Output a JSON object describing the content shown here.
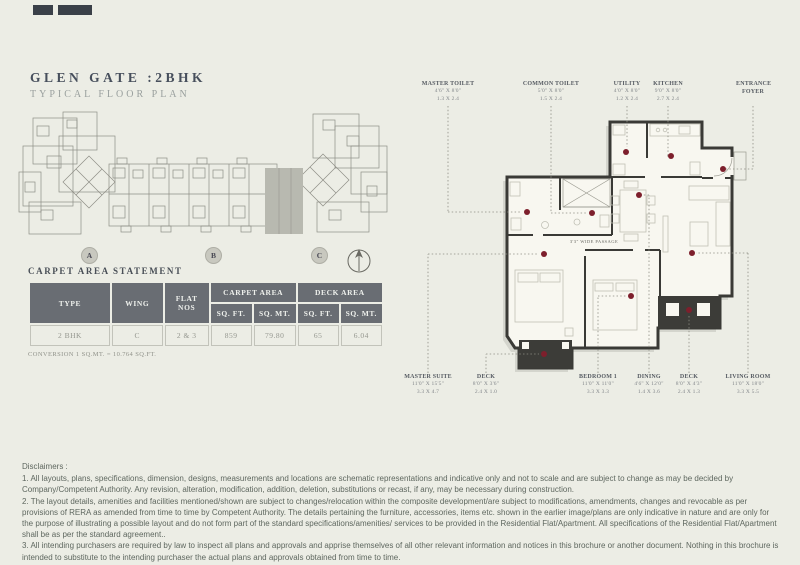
{
  "header": {
    "title": "GLEN GATE :2BHK",
    "subtitle": "TYPICAL FLOOR PLAN"
  },
  "key_plan": {
    "markers": [
      "A",
      "B",
      "C"
    ],
    "compass": "north-arrow",
    "highlight_color": "#b8b9b0"
  },
  "carpet_area": {
    "heading": "CARPET AREA STATEMENT",
    "columns": {
      "type": "TYPE",
      "wing": "WING",
      "flat_nos": "FLAT NOS",
      "carpet_area": "CARPET AREA",
      "deck_area": "DECK AREA",
      "sqft": "SQ. FT.",
      "sqmt": "SQ. MT."
    },
    "row": [
      "2 BHK",
      "C",
      "2 & 3",
      "859",
      "79.80",
      "65",
      "6.04"
    ],
    "note": "CONVERSION 1 SQ.MT. = 10.764 SQ.FT."
  },
  "floor_plan": {
    "passage_label": "3'3\" WIDE PASSAGE",
    "accent_dot_color": "#7d1f2c",
    "labels_top": [
      {
        "name": "MASTER TOILET",
        "ft": "4'6\" X 8'0\"",
        "mt": "1.3 X 2.4"
      },
      {
        "name": "COMMON TOILET",
        "ft": "5'0\" X 8'0\"",
        "mt": "1.5 X 2.4"
      },
      {
        "name": "UTILITY",
        "ft": "4'0\" X 8'0\"",
        "mt": "1.2 X 2.4"
      },
      {
        "name": "KITCHEN",
        "ft": "9'0\" X 8'0\"",
        "mt": "2.7 X 2.4"
      },
      {
        "name": "ENTRANCE FOYER",
        "ft": "",
        "mt": ""
      }
    ],
    "labels_bottom": [
      {
        "name": "MASTER SUITE",
        "ft": "11'0\" X 15'5\"",
        "mt": "3.3 X 4.7"
      },
      {
        "name": "DECK",
        "ft": "8'0\" X 3'6\"",
        "mt": "2.4 X 1.0"
      },
      {
        "name": "BEDROOM 1",
        "ft": "11'0\" X 11'0\"",
        "mt": "3.3 X 3.3"
      },
      {
        "name": "DINING",
        "ft": "4'6\" X 12'0\"",
        "mt": "1.4 X 3.6"
      },
      {
        "name": "DECK",
        "ft": "8'0\" X 4'3\"",
        "mt": "2.4 X 1.3"
      },
      {
        "name": "LIVING ROOM",
        "ft": "11'0\" X 18'0\"",
        "mt": "3.3 X 5.5"
      }
    ]
  },
  "disclaimers": {
    "heading": "Disclaimers :",
    "items": [
      "1. All layouts, plans, specifications, dimension, designs, measurements and locations are schematic representations and indicative only and not to scale and are subject to change as may be decided by Company/Competent Authority. Any revision, alteration, modification, addition, deletion, substitutions or recast, if any, may be necessary during construction.",
      "2. The layout details, amenities and facilities mentioned/shown are subject to changes/relocation within the composite development/are subject to modifications, amendments, changes and revocable as per provisions of RERA as amended from time to time by Competent Authority. The details pertaining the furniture, accessories, items etc. shown in the earlier image/plans are only indicative in nature and are only for the purpose of illustrating a possible layout and do not form part of the standard specifications/amenities/ services to be provided in the Residential Flat/Apartment. All specifications of the Residential Flat/Apartment shall be as per the standard agreement..",
      "3. All intending purchasers are required by law to inspect all plans and approvals and apprise themselves of all other relevant information and notices in this brochure or another document. Nothing in this brochure is intended to substitute to the intending purchaser the actual plans and approvals obtained from time to time."
    ]
  }
}
